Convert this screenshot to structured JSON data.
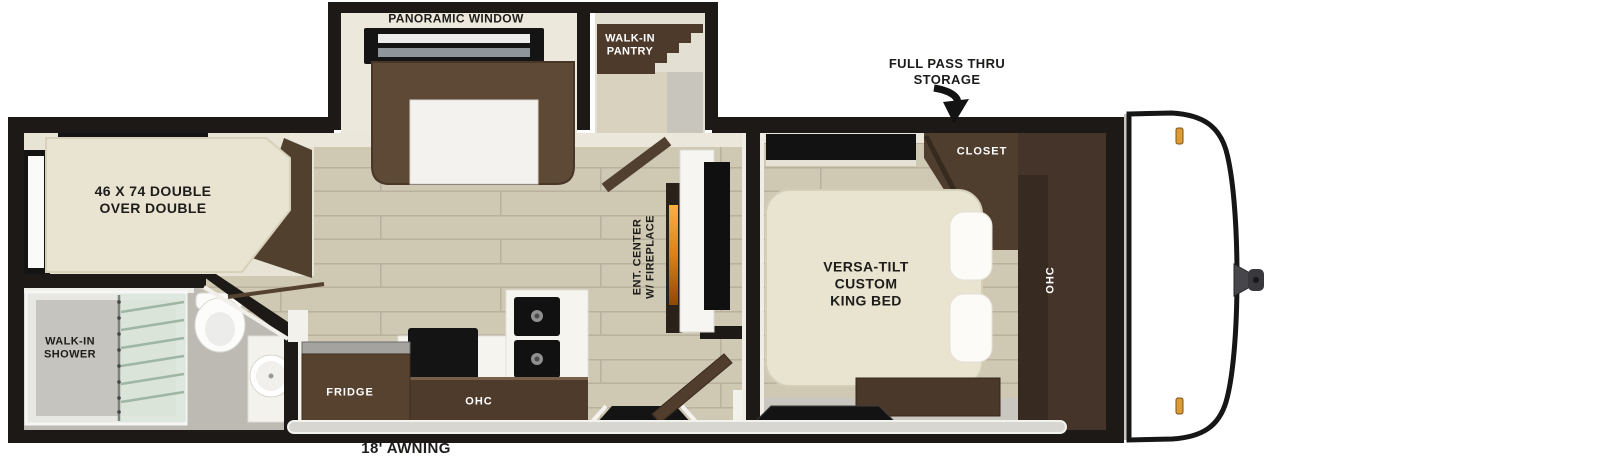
{
  "title": "Travel trailer floorplan",
  "colors": {
    "wall_black": "#1c1916",
    "wood_floor": "#cfc8b3",
    "bath_floor": "#bcbab3",
    "cream_wall": "#ece8dc",
    "cabinet_brown": "#4e3b2c",
    "sofa_brown": "#5e4937",
    "mattress_cream": "#e9e4d0",
    "fireplace_amber": "#e07f12",
    "marker_light_amber": "#dc9c35",
    "shower_glass_green": "#dde8dd"
  },
  "labels": {
    "panoramic_window": "PANORAMIC WINDOW",
    "walk_in_pantry": "WALK-IN\nPANTRY",
    "full_pass_thru_storage": "FULL PASS THRU\nSTORAGE",
    "closet": "CLOSET",
    "bunk_bed": "46 X 74 DOUBLE\nOVER DOUBLE",
    "ent_center": "ENT. CENTER\nW/ FIREPLACE",
    "king_bed": "VERSA-TILT\nCUSTOM\nKING BED",
    "bedroom_ohc": "OHC",
    "walk_in_shower": "WALK-IN\nSHOWER",
    "fridge": "FRIDGE",
    "kitchen_ohc": "OHC",
    "awning": "18' AWNING"
  }
}
